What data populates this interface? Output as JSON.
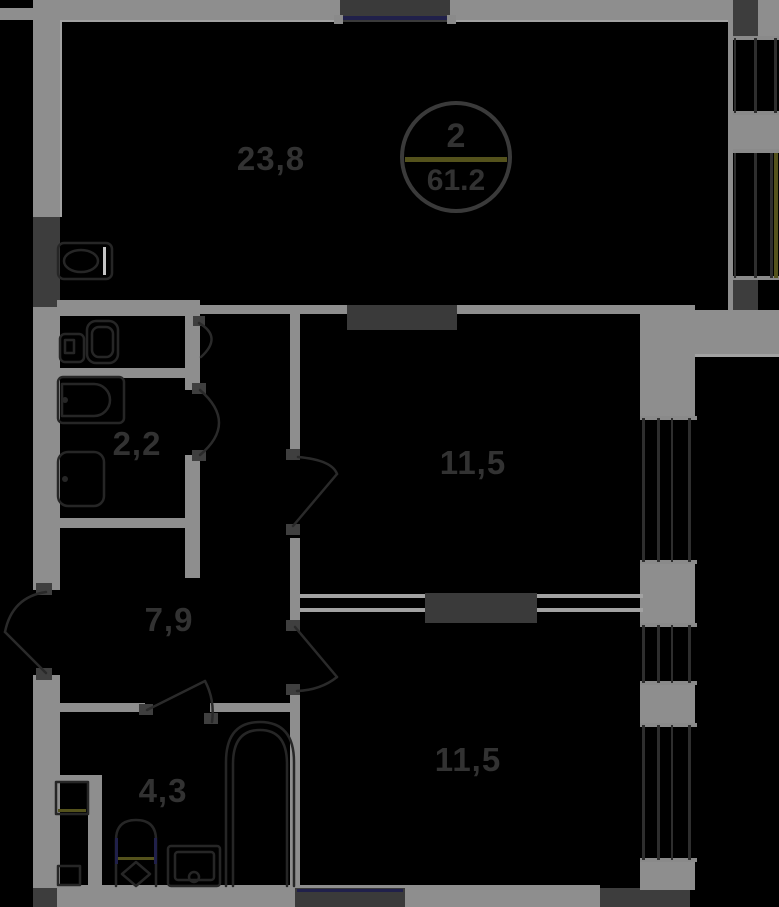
{
  "plan": {
    "badge": {
      "room_count": "2",
      "total_area": "61.2"
    },
    "rooms": [
      {
        "name": "living-kitchen",
        "area_label": "23,8"
      },
      {
        "name": "bathroom-small",
        "area_label": "2,2"
      },
      {
        "name": "hallway",
        "area_label": "7,9"
      },
      {
        "name": "bedroom-middle",
        "area_label": "11,5"
      },
      {
        "name": "bathroom-large",
        "area_label": "4,3"
      },
      {
        "name": "bedroom-bottom",
        "area_label": "11,5"
      }
    ],
    "colors": {
      "background": "#000000",
      "wall": "#8e8e8e",
      "wall_dark": "#3d3d3d",
      "wall_light_edge": "#a2a2a2",
      "window_slab": "#3a3a3a",
      "window_glass_navy": "#20204a",
      "accent_olive": "#54521c",
      "fixture_stroke": "#262626",
      "door_stroke": "#2a2a2a",
      "hinge": "#3f3f3f",
      "glazing_line": "#2e2e2e",
      "glazing_cap": "#8a8a8a",
      "label_text": "#323232",
      "badge_ring": "#3a3a3a"
    }
  }
}
